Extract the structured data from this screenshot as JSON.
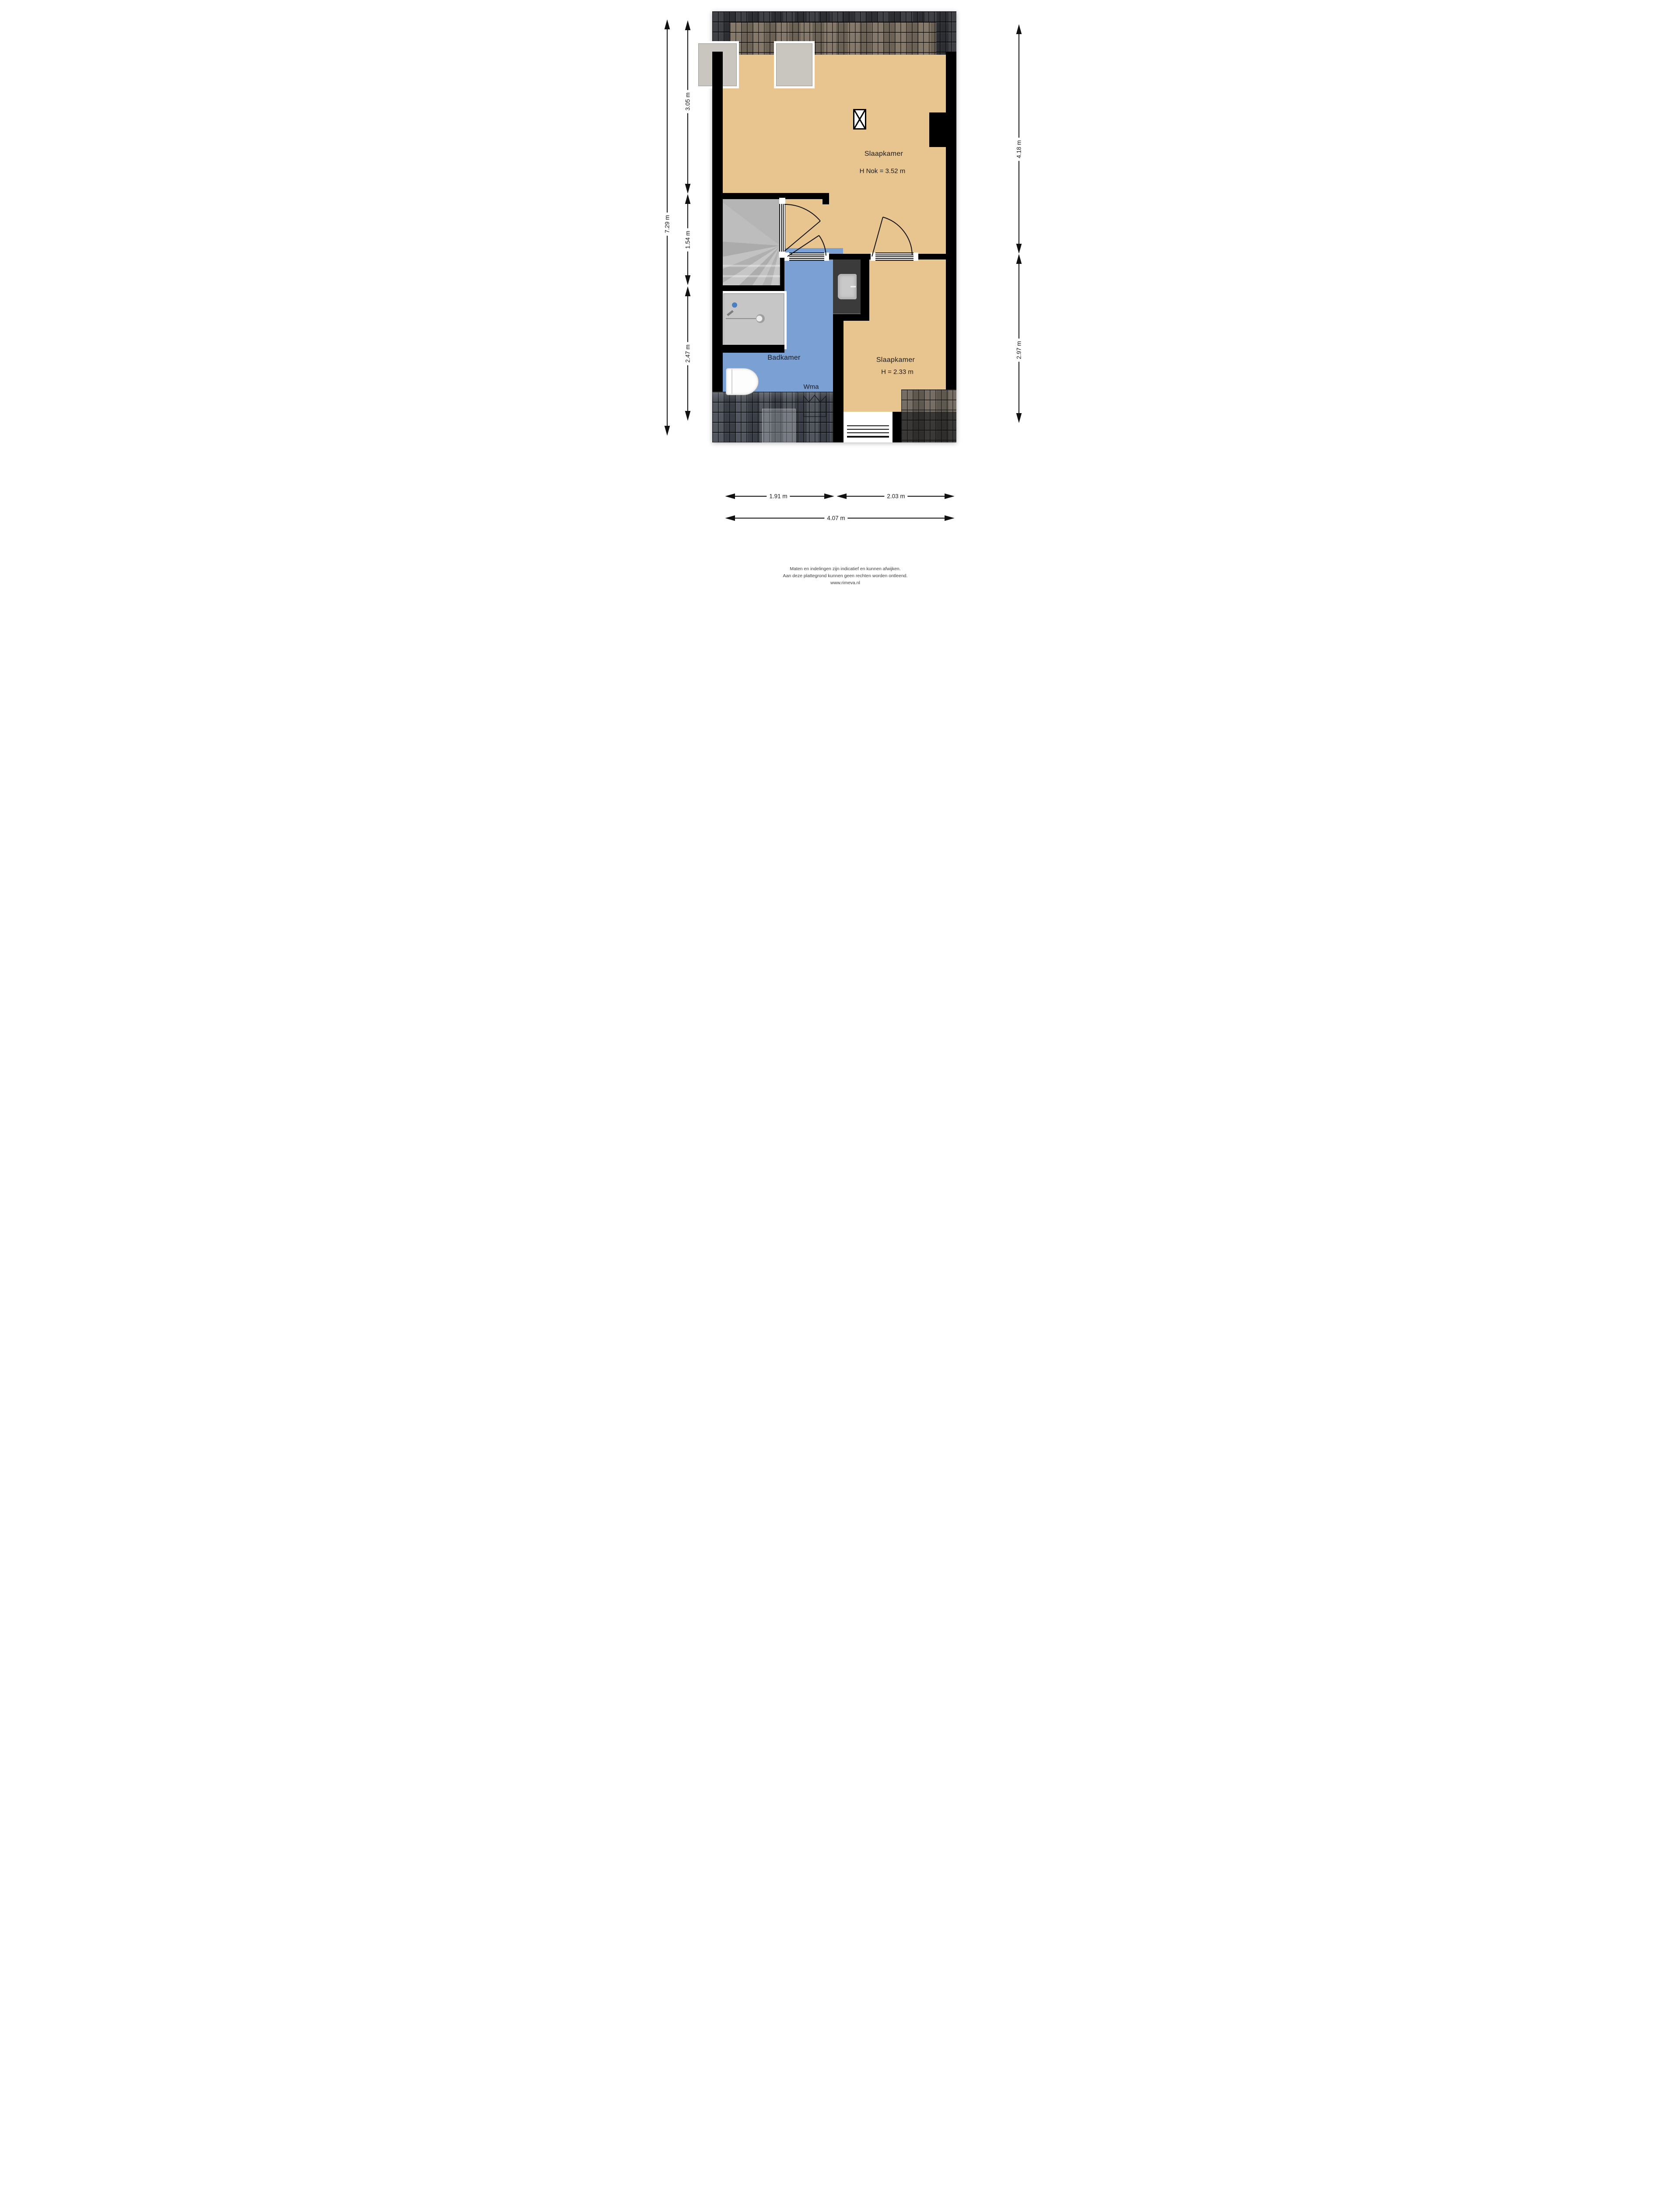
{
  "plan_type": "floorplan",
  "rooms": {
    "bedroom1": {
      "name": "Slaapkamer",
      "height_note": "H Nok = 3.52 m"
    },
    "bedroom2": {
      "name": "Slaapkamer",
      "height_note": "H = 2.33 m"
    },
    "bathroom": {
      "name": "Badkamer",
      "appliance_label": "Wma"
    }
  },
  "dimensions": {
    "left_total": "7.29 m",
    "left_top": "3.05 m",
    "left_middle": "1.54 m",
    "left_bottom": "2.47 m",
    "right_top": "4.18 m",
    "right_bottom": "2.97 m",
    "bottom_left": "1.91 m",
    "bottom_right": "2.03 m",
    "bottom_total": "4.07 m"
  },
  "footer": {
    "line1": "Maten en indelingen zijn indicatief en kunnen afwijken.",
    "line2": "Aan deze plattegrond kunnen geen rechten worden ontleend.",
    "line3": "www.rimeva.nl"
  },
  "colors": {
    "floor": "#e8c48e",
    "bathroom_floor": "#7ba0d4",
    "wall": "#000000",
    "stairs": "#b9b9b9",
    "roof_dark": "#34363b",
    "roof_brown": "#7d7163",
    "roof_slate": "#474c55",
    "drain_blue": "#4a7fc1"
  }
}
